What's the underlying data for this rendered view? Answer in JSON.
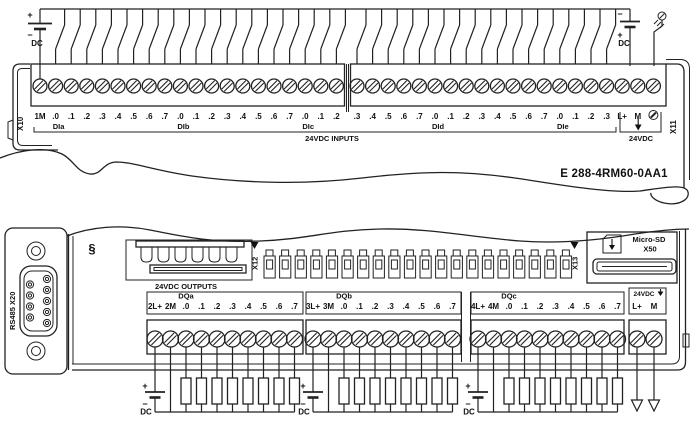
{
  "product_code": "E 288-4RM60-0AA1",
  "top_module": {
    "port_left": "X10",
    "port_right": "X11",
    "inputs_caption": "24VDC INPUTS",
    "supply_caption": "24VDC",
    "pin_labels_block1": [
      "1M",
      ".0",
      ".1",
      ".2",
      ".3",
      ".4",
      ".5",
      ".6",
      ".7",
      ".0",
      ".1",
      ".2",
      ".3",
      ".4",
      ".5",
      ".6",
      ".7",
      ".0",
      ".1",
      ".2"
    ],
    "pin_labels_block2": [
      ".3",
      ".4",
      ".5",
      ".6",
      ".7",
      ".0",
      ".1",
      ".2",
      ".3",
      ".4",
      ".5",
      ".6",
      ".7",
      ".0",
      ".1",
      ".2",
      ".3",
      "L+",
      "M"
    ],
    "group_names": [
      "DIa",
      "DIb",
      "DIc",
      "DId",
      "DIe"
    ],
    "dc_left": {
      "plus": "+",
      "minus": "−",
      "label": "DC"
    },
    "dc_right": {
      "plus": "+",
      "minus": "−",
      "label": "DC"
    }
  },
  "bottom_module": {
    "rs485_label": "RS485 X20",
    "grounding_symbol": "§",
    "bus_port_left": "X12",
    "bus_port_right": "X13",
    "sd_card_label": "Micro-SD",
    "sd_port": "X50",
    "outputs_caption": "24VDC OUTPUTS",
    "supply_caption": "24VDC",
    "supply_pins": [
      "L+",
      "M"
    ],
    "group_names": [
      "DQa",
      "DQb",
      "DQc"
    ],
    "blocks": [
      {
        "power": [
          "2L+",
          "2M"
        ],
        "pins": [
          ".0",
          ".1",
          ".2",
          ".3",
          ".4",
          ".5",
          ".6",
          ".7"
        ]
      },
      {
        "power": [
          "3L+",
          "3M"
        ],
        "pins": [
          ".0",
          ".1",
          ".2",
          ".3",
          ".4",
          ".5",
          ".6",
          ".7"
        ]
      },
      {
        "power": [
          "4L+",
          "4M"
        ],
        "pins": [
          ".0",
          ".1",
          ".2",
          ".3",
          ".4",
          ".5",
          ".6",
          ".7"
        ]
      }
    ],
    "dc_plus": "+",
    "dc_minus": "−",
    "dc_labels": [
      "DC",
      "DC",
      "DC"
    ]
  }
}
